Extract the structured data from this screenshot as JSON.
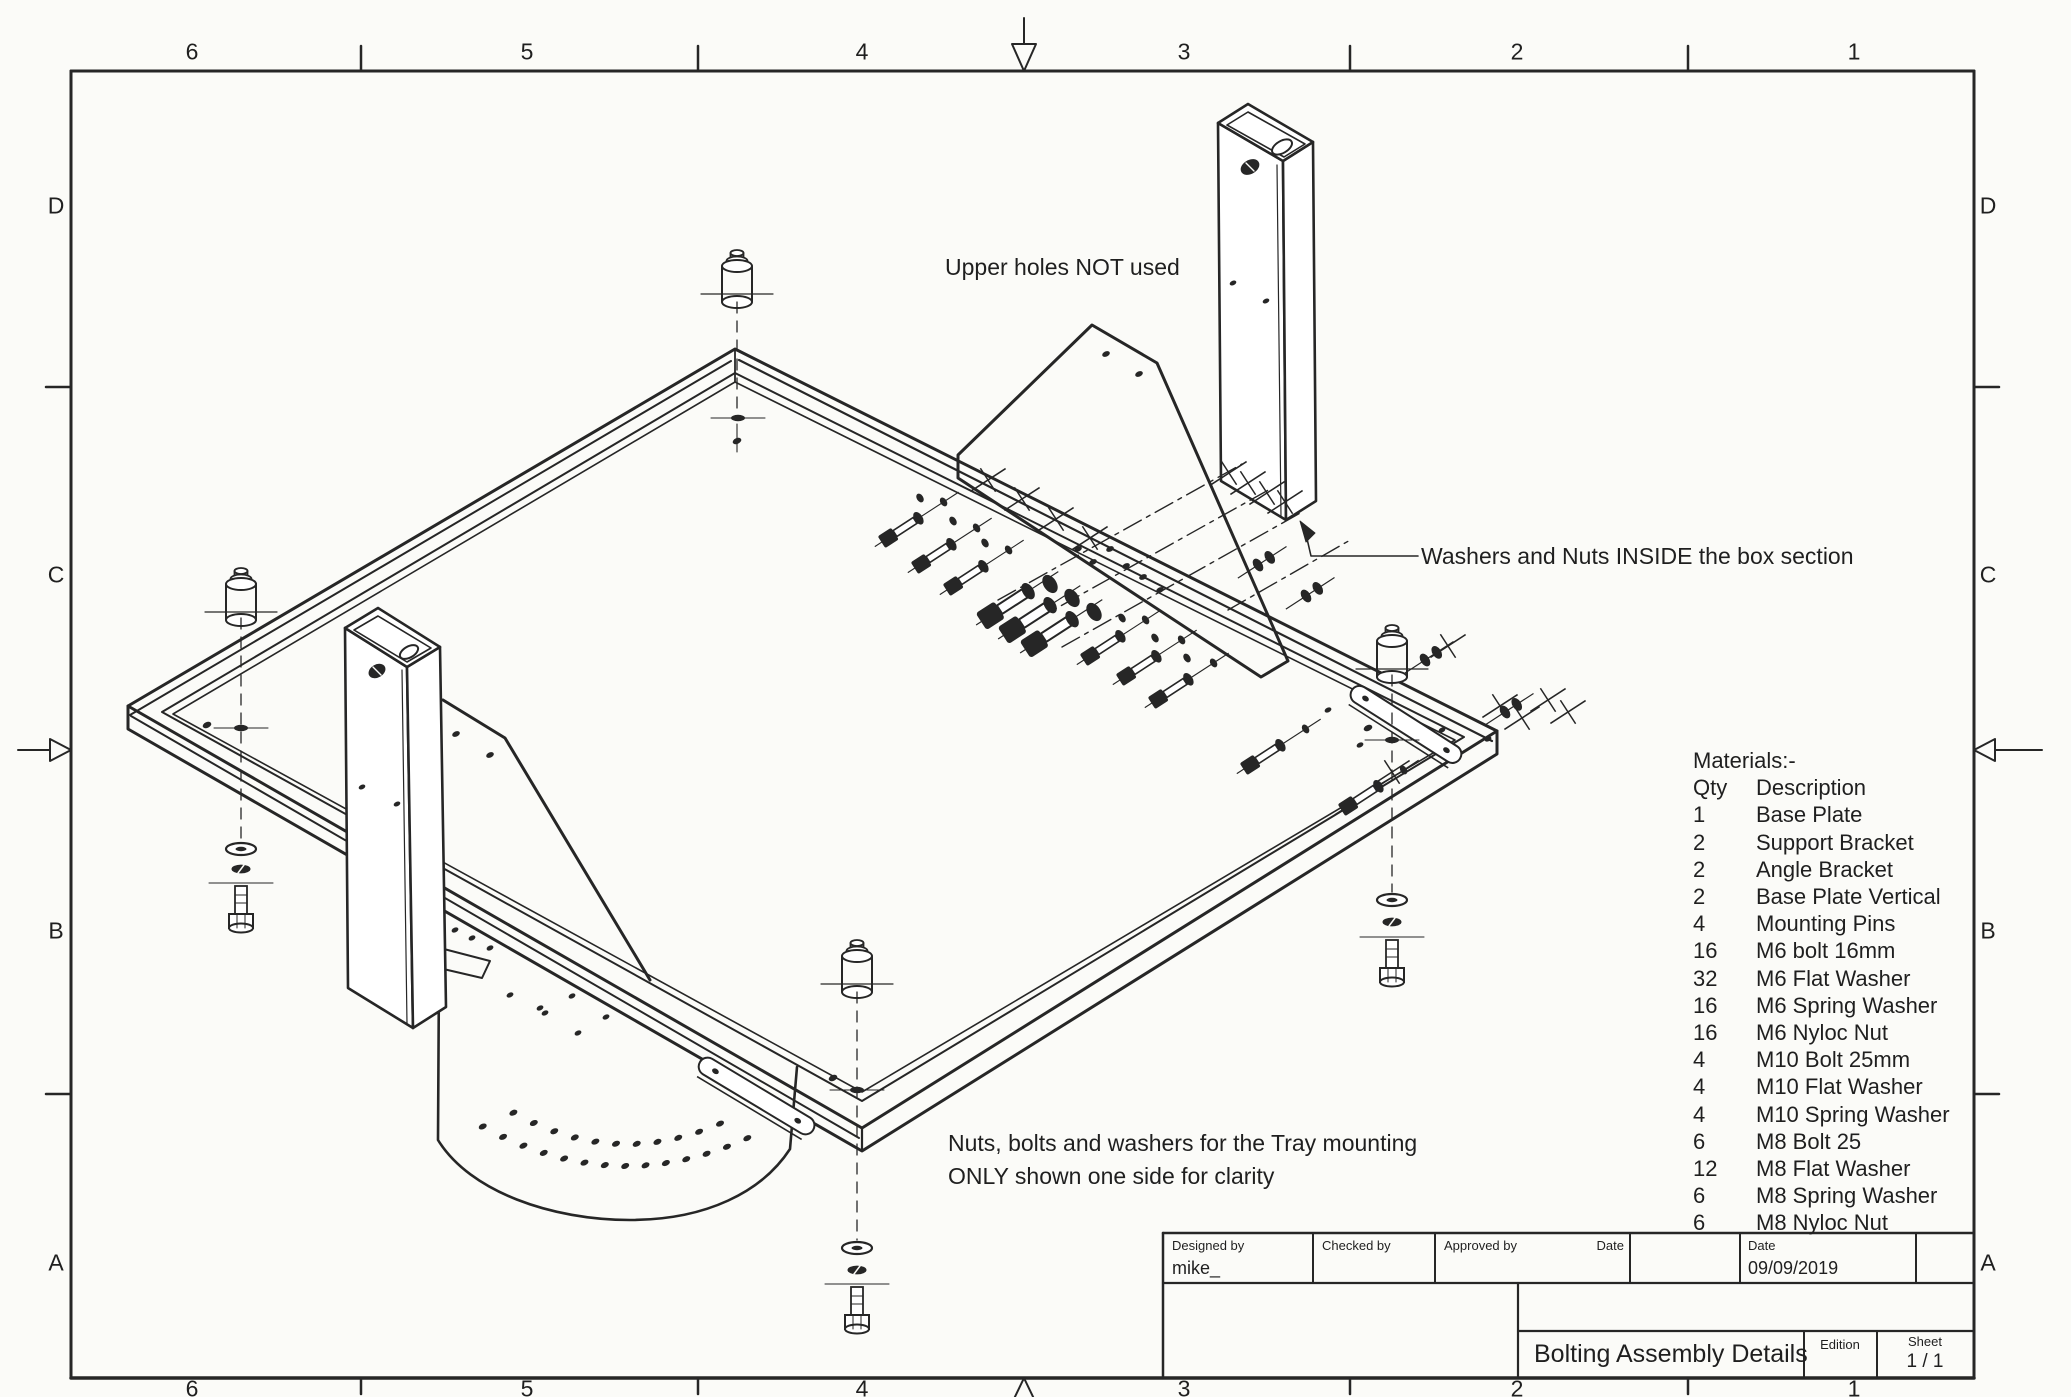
{
  "sheet": {
    "paper": "#fbfbf8",
    "ink": "#262626"
  },
  "border": {
    "top_labels": [
      "6",
      "5",
      "4",
      "3",
      "2",
      "1"
    ],
    "bottom_labels": [
      "6",
      "5",
      "4",
      "3",
      "2",
      "1"
    ],
    "left_labels": [
      "D",
      "C",
      "B",
      "A"
    ],
    "right_labels": [
      "D",
      "C",
      "B",
      "A"
    ]
  },
  "annotations": {
    "upper_holes": "Upper holes NOT used",
    "washers_nuts": "Washers and Nuts INSIDE the box section",
    "tray_note_line1": "Nuts, bolts and washers for the Tray mounting",
    "tray_note_line2": "ONLY shown one side for clarity"
  },
  "materials": {
    "title": "Materials:-",
    "qty_header": "Qty",
    "desc_header": "Description",
    "items": [
      {
        "qty": "1",
        "desc": "Base Plate"
      },
      {
        "qty": "2",
        "desc": "Support Bracket"
      },
      {
        "qty": "2",
        "desc": "Angle Bracket"
      },
      {
        "qty": "2",
        "desc": "Base Plate Vertical"
      },
      {
        "qty": "4",
        "desc": "Mounting Pins"
      },
      {
        "qty": "16",
        "desc": "M6 bolt 16mm"
      },
      {
        "qty": "32",
        "desc": "M6 Flat Washer"
      },
      {
        "qty": "16",
        "desc": "M6 Spring Washer"
      },
      {
        "qty": "16",
        "desc": "M6 Nyloc Nut"
      },
      {
        "qty": "4",
        "desc": "M10 Bolt 25mm"
      },
      {
        "qty": "4",
        "desc": "M10 Flat Washer"
      },
      {
        "qty": "4",
        "desc": "M10 Spring Washer"
      },
      {
        "qty": "6",
        "desc": "M8 Bolt 25"
      },
      {
        "qty": "12",
        "desc": "M8 Flat Washer"
      },
      {
        "qty": "6",
        "desc": "M8 Spring Washer"
      },
      {
        "qty": "6",
        "desc": "M8 Nyloc Nut"
      }
    ]
  },
  "title_block": {
    "designed_by_label": "Designed by",
    "designed_by_value": "mike_",
    "checked_by_label": "Checked by",
    "approved_by_label": "Approved by",
    "approved_date_label": "Date",
    "date_label": "Date",
    "date_value": "09/09/2019",
    "drawing_title": "Bolting Assembly Details",
    "edition_label": "Edition",
    "sheet_label": "Sheet",
    "sheet_value": "1 / 1"
  }
}
